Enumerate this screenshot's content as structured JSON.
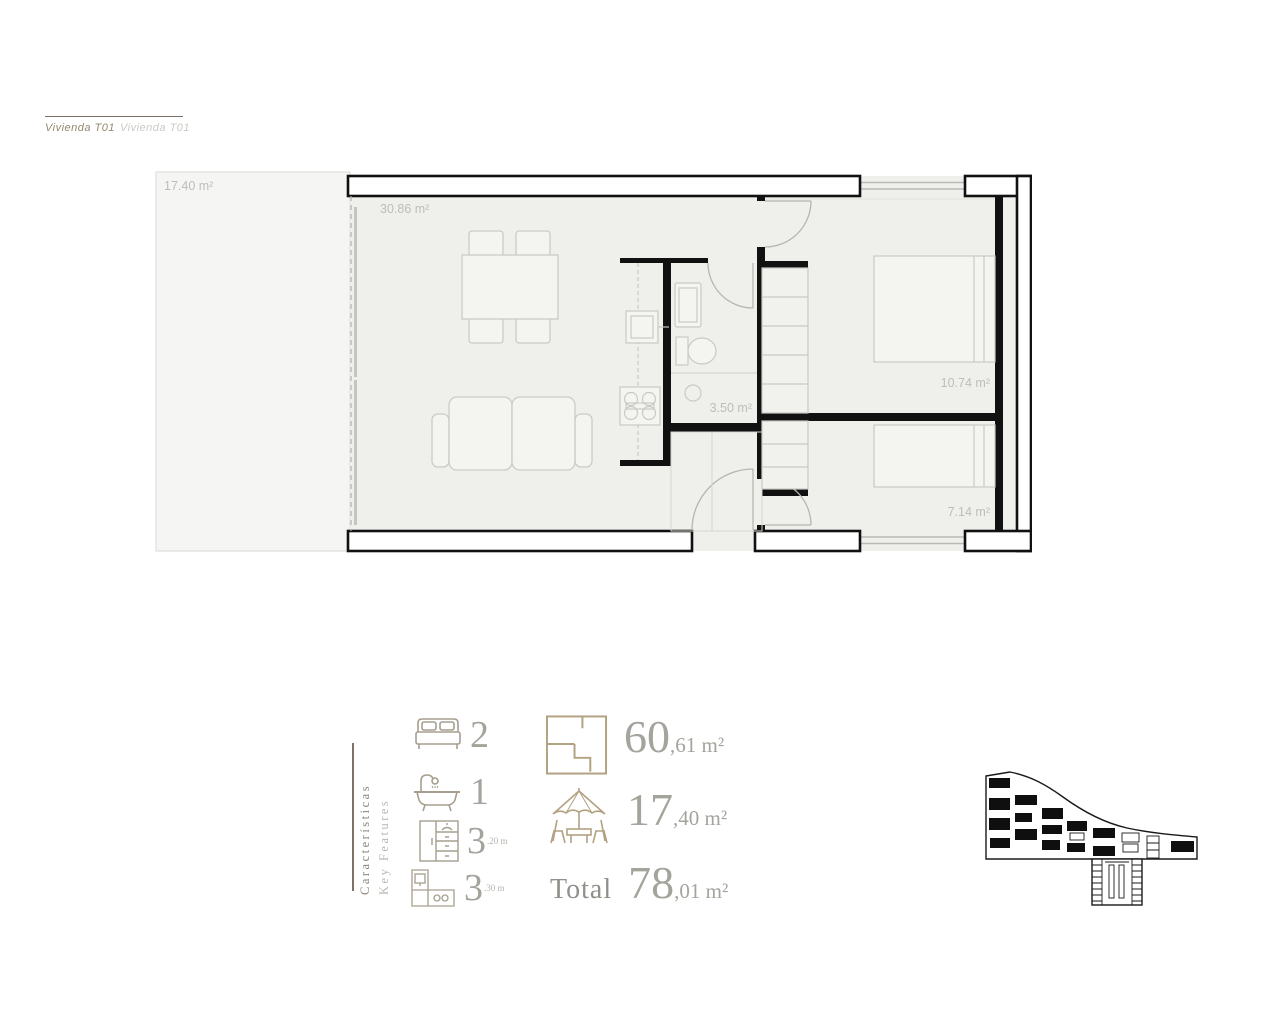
{
  "header": {
    "title_primary": "Vivienda T01",
    "title_secondary": "Vivienda T01"
  },
  "floor_plan": {
    "terrace_area": "17.40 m²",
    "living_area": "30.86 m²",
    "bathroom_area": "3.50 m²",
    "bedroom1_area": "10.74 m²",
    "bedroom2_area": "7.14 m²"
  },
  "features": {
    "heading_es": "Características",
    "heading_en": "Key Features",
    "bedrooms_count": "2",
    "bathrooms_count": "1",
    "wardrobes_count": "3",
    "wardrobes_detail": ".20 m",
    "kitchen_count": "3",
    "kitchen_detail": ".30 m"
  },
  "areas": {
    "built_whole": "60",
    "built_fraction": ",61 m²",
    "terrace_whole": "17",
    "terrace_fraction": ",40 m²",
    "total_label": "Total",
    "total_whole": "78",
    "total_fraction": ",01 m²"
  },
  "colors": {
    "wall_black": "#111111",
    "icon_tan": "#b2a282",
    "feature_icon_gray": "#a69e8f",
    "number_gray": "#a4a49c",
    "accent_rule": "#7c7365"
  }
}
